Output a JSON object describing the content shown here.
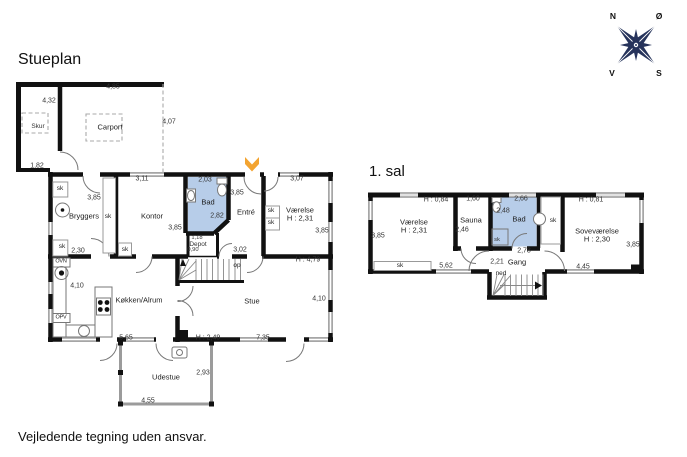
{
  "page": {
    "ground_title": "Stueplan",
    "first_title": "1. sal",
    "disclaimer": "Vejledende tegning uden ansvar."
  },
  "compass": {
    "north": "N",
    "east": "Ø",
    "south": "S",
    "west": "V"
  },
  "colors": {
    "wall": "#111111",
    "window": "#b0b0b0",
    "bath": "#b7cde9",
    "accent": "#f3a431",
    "navy": "#26335b",
    "outdoor": "#9b9b9b"
  },
  "plans": [
    {
      "id": "stueplan",
      "labels": [
        {
          "text": "Skur",
          "kind": "room-sm",
          "x": 38,
          "y": 127,
          "name": "room-label-skur"
        },
        {
          "text": "Carport",
          "kind": "room",
          "x": 110,
          "y": 127,
          "name": "room-label-carport"
        },
        {
          "text": "Bryggers",
          "kind": "room",
          "x": 84,
          "y": 216,
          "name": "room-label-bryggers"
        },
        {
          "text": "Kontor",
          "kind": "room",
          "x": 152,
          "y": 216,
          "name": "room-label-kontor"
        },
        {
          "text": "Bad",
          "kind": "room",
          "x": 208,
          "y": 202,
          "name": "room-label-bad"
        },
        {
          "text": "Entré",
          "kind": "room",
          "x": 246,
          "y": 212,
          "name": "room-label-entre"
        },
        {
          "text": "Depot",
          "kind": "room-sm",
          "x": 198,
          "y": 245,
          "name": "room-label-depot"
        },
        {
          "text": "Værelse",
          "kind": "room",
          "x": 300,
          "y": 210,
          "name": "room-label-vaerelse"
        },
        {
          "text": "H : 2,31",
          "kind": "room",
          "x": 300,
          "y": 218,
          "name": "room-height-vaerelse"
        },
        {
          "text": "Stue",
          "kind": "room",
          "x": 252,
          "y": 301,
          "name": "room-label-stue"
        },
        {
          "text": "Køkken/Alrum",
          "kind": "room",
          "x": 139,
          "y": 300,
          "name": "room-label-koekken"
        },
        {
          "text": "Udestue",
          "kind": "room",
          "x": 166,
          "y": 377,
          "name": "room-label-udestue"
        },
        {
          "text": "4,85",
          "kind": "dim",
          "x": 113,
          "y": 87
        },
        {
          "text": "4,32",
          "kind": "dim",
          "x": 49,
          "y": 101
        },
        {
          "text": "4,07",
          "kind": "dim",
          "x": 169,
          "y": 122
        },
        {
          "text": "1,82",
          "kind": "dim",
          "x": 37,
          "y": 166
        },
        {
          "text": "3,11",
          "kind": "dim",
          "x": 142,
          "y": 179
        },
        {
          "text": "2,03",
          "kind": "dim",
          "x": 205,
          "y": 180
        },
        {
          "text": "3,07",
          "kind": "dim",
          "x": 297,
          "y": 179
        },
        {
          "text": "3,85",
          "kind": "dim",
          "x": 94,
          "y": 198
        },
        {
          "text": "3,85",
          "kind": "dim",
          "x": 175,
          "y": 228
        },
        {
          "text": "3,85",
          "kind": "dim",
          "x": 237,
          "y": 193
        },
        {
          "text": "3,85",
          "kind": "dim",
          "x": 322,
          "y": 231
        },
        {
          "text": "2,82",
          "kind": "dim",
          "x": 217,
          "y": 216
        },
        {
          "text": "2,30",
          "kind": "dim",
          "x": 78,
          "y": 251
        },
        {
          "text": "1,18",
          "kind": "dim-sm",
          "x": 197,
          "y": 239
        },
        {
          "text": "0,90",
          "kind": "dim-sm",
          "x": 193,
          "y": 251
        },
        {
          "text": "3,02",
          "kind": "dim",
          "x": 240,
          "y": 250
        },
        {
          "text": "H : 4,79",
          "kind": "dim",
          "x": 308,
          "y": 260
        },
        {
          "text": "4,10",
          "kind": "dim",
          "x": 77,
          "y": 286
        },
        {
          "text": "4,10",
          "kind": "dim",
          "x": 319,
          "y": 299
        },
        {
          "text": "5,65",
          "kind": "dim",
          "x": 126,
          "y": 338
        },
        {
          "text": "H : 2,49",
          "kind": "dim",
          "x": 208,
          "y": 338
        },
        {
          "text": "7,35",
          "kind": "dim",
          "x": 263,
          "y": 338
        },
        {
          "text": "2,93",
          "kind": "dim",
          "x": 203,
          "y": 373
        },
        {
          "text": "4,55",
          "kind": "dim",
          "x": 148,
          "y": 401
        },
        {
          "text": "sk",
          "kind": "sk",
          "x": 60,
          "y": 189
        },
        {
          "text": "sk",
          "kind": "sk",
          "x": 108,
          "y": 217
        },
        {
          "text": "sk",
          "kind": "sk",
          "x": 62,
          "y": 247
        },
        {
          "text": "sk",
          "kind": "sk",
          "x": 125,
          "y": 250
        },
        {
          "text": "sk",
          "kind": "sk",
          "x": 271,
          "y": 211
        },
        {
          "text": "sk",
          "kind": "sk",
          "x": 271,
          "y": 223
        },
        {
          "text": "op",
          "kind": "sk",
          "x": 237,
          "y": 266,
          "name": "stair-direction-label"
        },
        {
          "text": "OVN",
          "kind": "appl",
          "x": 61,
          "y": 262,
          "name": "appliance-label-oven"
        },
        {
          "text": "OPV",
          "kind": "appl",
          "x": 61,
          "y": 318,
          "name": "appliance-label-dishwasher"
        }
      ]
    },
    {
      "id": "firstfloor",
      "labels": [
        {
          "text": "Værelse",
          "kind": "room",
          "x": 414,
          "y": 222,
          "name": "room-label-vaerelse-1sal"
        },
        {
          "text": "H : 2,31",
          "kind": "room",
          "x": 414,
          "y": 230,
          "name": "room-height-vaerelse-1sal"
        },
        {
          "text": "Sauna",
          "kind": "room",
          "x": 471,
          "y": 220,
          "name": "room-label-sauna"
        },
        {
          "text": "Bad",
          "kind": "room",
          "x": 519,
          "y": 219,
          "name": "room-label-bad-1sal"
        },
        {
          "text": "Soveværelse",
          "kind": "room",
          "x": 597,
          "y": 231,
          "name": "room-label-sovevaerelse"
        },
        {
          "text": "H : 2,30",
          "kind": "room",
          "x": 597,
          "y": 239,
          "name": "room-height-sovevaerelse"
        },
        {
          "text": "Gang",
          "kind": "room",
          "x": 517,
          "y": 262,
          "name": "room-label-gang"
        },
        {
          "text": "ned",
          "kind": "sk",
          "x": 501,
          "y": 274,
          "name": "stair-direction-label"
        },
        {
          "text": "H : 0,84",
          "kind": "dim",
          "x": 436,
          "y": 200
        },
        {
          "text": "1,60",
          "kind": "dim",
          "x": 473,
          "y": 199
        },
        {
          "text": "2,66",
          "kind": "dim",
          "x": 521,
          "y": 199
        },
        {
          "text": "H : 0,81",
          "kind": "dim",
          "x": 591,
          "y": 200
        },
        {
          "text": "3,85",
          "kind": "dim",
          "x": 378,
          "y": 236
        },
        {
          "text": "2,46",
          "kind": "dim",
          "x": 462,
          "y": 230
        },
        {
          "text": "2,48",
          "kind": "dim",
          "x": 503,
          "y": 211
        },
        {
          "text": "3,85",
          "kind": "dim",
          "x": 633,
          "y": 245
        },
        {
          "text": "2,78",
          "kind": "dim",
          "x": 524,
          "y": 251
        },
        {
          "text": "2,21",
          "kind": "dim",
          "x": 497,
          "y": 262
        },
        {
          "text": "5,62",
          "kind": "dim",
          "x": 446,
          "y": 266
        },
        {
          "text": "4,45",
          "kind": "dim",
          "x": 583,
          "y": 267
        },
        {
          "text": "sk",
          "kind": "sk",
          "x": 400,
          "y": 266
        },
        {
          "text": "sk",
          "kind": "sk",
          "x": 553,
          "y": 221
        },
        {
          "text": "sk",
          "kind": "dim-sm",
          "x": 497,
          "y": 241
        }
      ]
    }
  ]
}
